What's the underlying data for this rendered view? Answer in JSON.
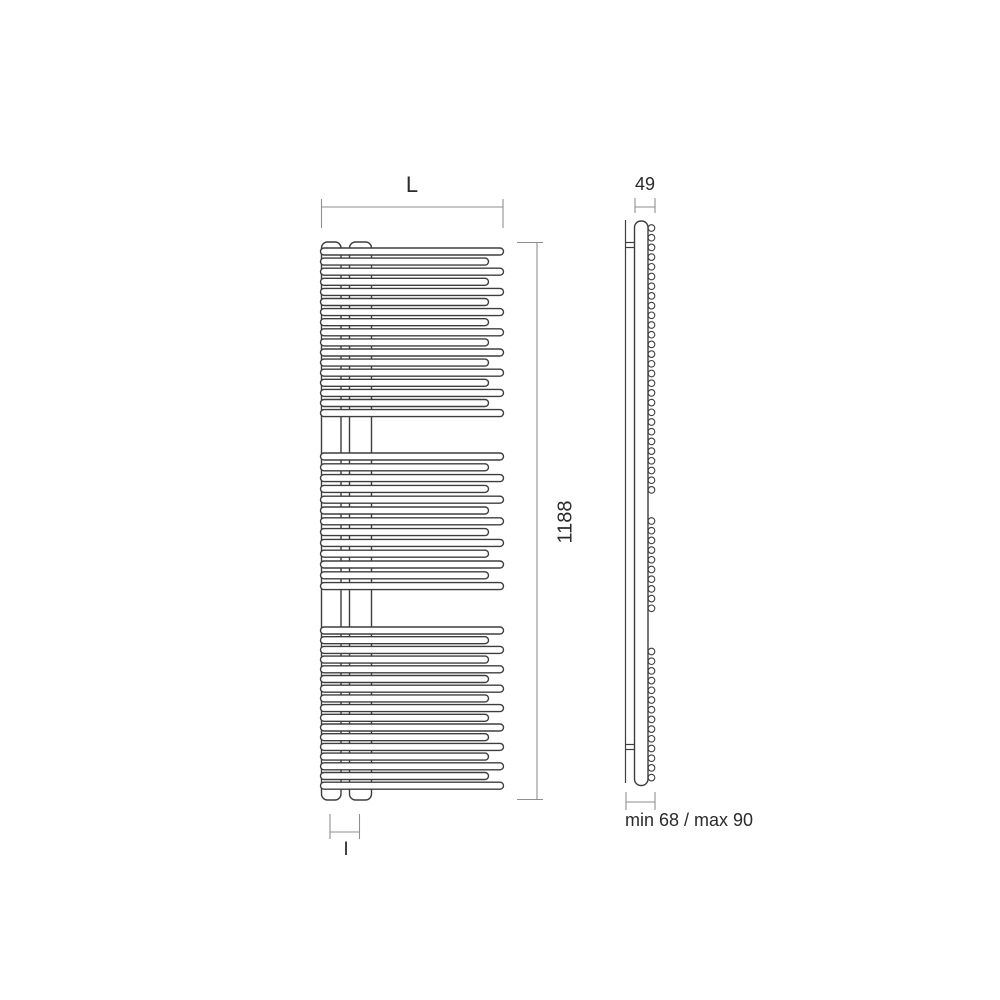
{
  "diagram": {
    "type": "technical-drawing-towel-radiator",
    "labels": {
      "width": "L",
      "height": "1188",
      "depth": "49",
      "collector_spacing": "I",
      "wall_distance": "min 68 / max 90"
    },
    "front_view": {
      "tube_group_counts": [
        17,
        13,
        17
      ],
      "collector_count": 2
    },
    "side_view": {
      "tube_circle_group_counts": [
        28,
        10,
        14
      ],
      "wall_bracket_count": 2
    },
    "colors": {
      "outline": "#3e3e3e",
      "dimension_line": "#8f8f8f",
      "text": "#2b2b2b",
      "fill": "#ffffff",
      "background": "#ffffff"
    }
  }
}
